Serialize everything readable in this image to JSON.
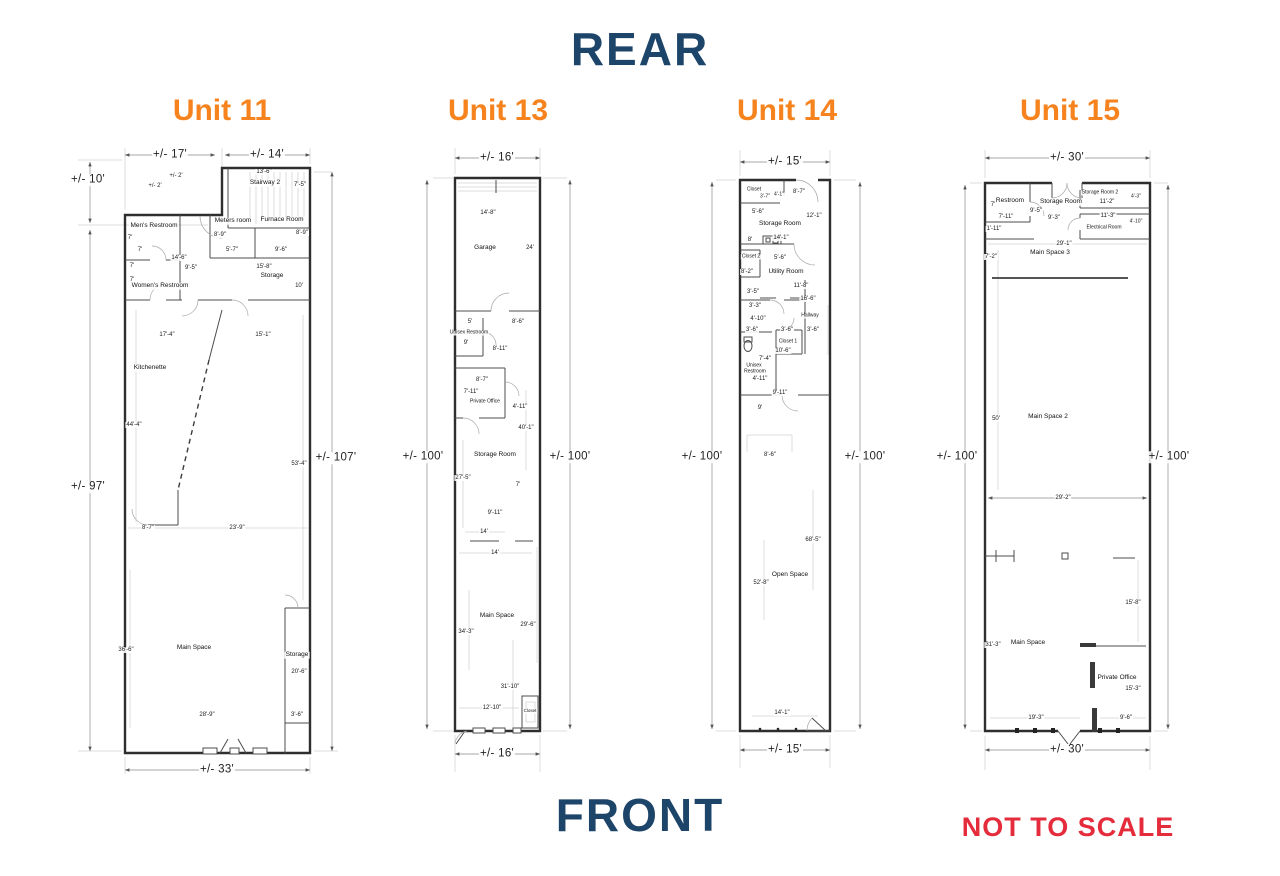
{
  "page": {
    "rear_label": "REAR",
    "front_label": "FRONT",
    "not_to_scale": "NOT TO SCALE",
    "colors": {
      "heading_navy": "#1d4469",
      "unit_orange": "#f6831d",
      "warning_red": "#e52c3c",
      "wall": "#2e2e2e"
    }
  },
  "units": [
    {
      "title": "Unit 11",
      "labels": [
        {
          "t": "+/- 17'",
          "x": 100,
          "y": 15,
          "c": "big"
        },
        {
          "t": "+/- 14'",
          "x": 197,
          "y": 15,
          "c": "big"
        },
        {
          "t": "+/- 10'",
          "x": 18,
          "y": 40,
          "c": "big"
        },
        {
          "t": "+/- 97'",
          "x": 18,
          "y": 347,
          "c": "big"
        },
        {
          "t": "+/- 107'",
          "x": 266,
          "y": 318,
          "c": "big"
        },
        {
          "t": "+/- 33'",
          "x": 147,
          "y": 630,
          "c": "big"
        },
        {
          "t": "+/- 2'",
          "x": 106,
          "y": 36
        },
        {
          "t": "+/- 2'",
          "x": 85,
          "y": 46
        },
        {
          "t": "13'-6\"",
          "x": 194,
          "y": 32
        },
        {
          "t": "Stairway 2",
          "x": 195,
          "y": 43,
          "c": "room"
        },
        {
          "t": "7'-5\"",
          "x": 230,
          "y": 45
        },
        {
          "t": "Meters room",
          "x": 163,
          "y": 81,
          "c": "room"
        },
        {
          "t": "Furnace Room",
          "x": 212,
          "y": 80,
          "c": "room"
        },
        {
          "t": "8'-9\"",
          "x": 150,
          "y": 95
        },
        {
          "t": "8'-9\"",
          "x": 232,
          "y": 93
        },
        {
          "t": "5'-7\"",
          "x": 162,
          "y": 110
        },
        {
          "t": "9'-6\"",
          "x": 211,
          "y": 110
        },
        {
          "t": "15'-8\"",
          "x": 194,
          "y": 127
        },
        {
          "t": "Storage",
          "x": 202,
          "y": 136,
          "c": "room"
        },
        {
          "t": "10'",
          "x": 229,
          "y": 146
        },
        {
          "t": "Men's Restroom",
          "x": 84,
          "y": 86,
          "c": "room"
        },
        {
          "t": "7'",
          "x": 60,
          "y": 98
        },
        {
          "t": "7'",
          "x": 70,
          "y": 110
        },
        {
          "t": "14'-6\"",
          "x": 109,
          "y": 118
        },
        {
          "t": "7'",
          "x": 62,
          "y": 126
        },
        {
          "t": "9'-5\"",
          "x": 121,
          "y": 128
        },
        {
          "t": "7'",
          "x": 62,
          "y": 140
        },
        {
          "t": "Women's Restroom",
          "x": 90,
          "y": 146,
          "c": "room"
        },
        {
          "t": "17'-4\"",
          "x": 97,
          "y": 195
        },
        {
          "t": "15'-1\"",
          "x": 193,
          "y": 195
        },
        {
          "t": "Kitchenette",
          "x": 80,
          "y": 228,
          "c": "room"
        },
        {
          "t": "44'-4\"",
          "x": 64,
          "y": 285
        },
        {
          "t": "53'-4\"",
          "x": 229,
          "y": 324
        },
        {
          "t": "8'-7\"",
          "x": 78,
          "y": 388
        },
        {
          "t": "23'-9\"",
          "x": 167,
          "y": 388
        },
        {
          "t": "36'-6\"",
          "x": 56,
          "y": 510
        },
        {
          "t": "Main Space",
          "x": 124,
          "y": 508,
          "c": "room"
        },
        {
          "t": "Storage",
          "x": 227,
          "y": 515,
          "c": "room"
        },
        {
          "t": "20'-6\"",
          "x": 229,
          "y": 532
        },
        {
          "t": "28'-9\"",
          "x": 137,
          "y": 575
        },
        {
          "t": "3'-6\"",
          "x": 227,
          "y": 575
        }
      ]
    },
    {
      "title": "Unit 13",
      "labels": [
        {
          "t": "+/- 16'",
          "x": 102,
          "y": 18,
          "c": "big"
        },
        {
          "t": "+/- 100'",
          "x": 28,
          "y": 317,
          "c": "big"
        },
        {
          "t": "+/- 100'",
          "x": 175,
          "y": 317,
          "c": "big"
        },
        {
          "t": "+/- 16'",
          "x": 102,
          "y": 614,
          "c": "big"
        },
        {
          "t": "14'-8\"",
          "x": 93,
          "y": 73
        },
        {
          "t": "Garage",
          "x": 90,
          "y": 108,
          "c": "room"
        },
        {
          "t": "24'",
          "x": 135,
          "y": 108
        },
        {
          "t": "5'",
          "x": 75,
          "y": 182
        },
        {
          "t": "8'-6\"",
          "x": 123,
          "y": 182
        },
        {
          "t": "Unisex Restroom",
          "x": 74,
          "y": 193,
          "c": "room",
          "s": 5
        },
        {
          "t": "9'",
          "x": 71,
          "y": 203
        },
        {
          "t": "8'-11\"",
          "x": 105,
          "y": 209
        },
        {
          "t": "8'-7\"",
          "x": 87,
          "y": 240
        },
        {
          "t": "7'-11\"",
          "x": 76,
          "y": 252
        },
        {
          "t": "Private Office",
          "x": 90,
          "y": 262,
          "c": "room",
          "s": 5
        },
        {
          "t": "4'-11\"",
          "x": 125,
          "y": 267
        },
        {
          "t": "40'-1\"",
          "x": 131,
          "y": 288
        },
        {
          "t": "Storage Room",
          "x": 100,
          "y": 315,
          "c": "room"
        },
        {
          "t": "27'-5\"",
          "x": 68,
          "y": 338
        },
        {
          "t": "7'",
          "x": 123,
          "y": 345
        },
        {
          "t": "9'-11\"",
          "x": 100,
          "y": 373
        },
        {
          "t": "14'",
          "x": 89,
          "y": 392
        },
        {
          "t": "14'",
          "x": 100,
          "y": 413
        },
        {
          "t": "Main Space",
          "x": 102,
          "y": 476,
          "c": "room"
        },
        {
          "t": "29'-6\"",
          "x": 133,
          "y": 485
        },
        {
          "t": "34'-3\"",
          "x": 71,
          "y": 492
        },
        {
          "t": "31'-10\"",
          "x": 115,
          "y": 547
        },
        {
          "t": "12'-10\"",
          "x": 97,
          "y": 568
        },
        {
          "t": "Closet",
          "x": 135,
          "y": 571,
          "c": "room",
          "s": 4.5
        }
      ]
    },
    {
      "title": "Unit 14",
      "labels": [
        {
          "t": "+/- 15'",
          "x": 125,
          "y": 22,
          "c": "big"
        },
        {
          "t": "+/- 100'",
          "x": 42,
          "y": 317,
          "c": "big"
        },
        {
          "t": "+/- 100'",
          "x": 205,
          "y": 317,
          "c": "big"
        },
        {
          "t": "+/- 15'",
          "x": 125,
          "y": 610,
          "c": "big"
        },
        {
          "t": "Closet",
          "x": 94,
          "y": 50,
          "c": "room",
          "s": 5
        },
        {
          "t": "3'-7\"",
          "x": 105,
          "y": 57,
          "s": 5
        },
        {
          "t": "4'-1\"",
          "x": 119,
          "y": 55,
          "s": 5
        },
        {
          "t": "8'-7\"",
          "x": 139,
          "y": 52
        },
        {
          "t": "5'-6\"",
          "x": 98,
          "y": 72
        },
        {
          "t": "Storage Room",
          "x": 120,
          "y": 84,
          "c": "room"
        },
        {
          "t": "12'-1\"",
          "x": 154,
          "y": 76
        },
        {
          "t": "8'",
          "x": 90,
          "y": 100
        },
        {
          "t": "14'-1\"",
          "x": 121,
          "y": 98
        },
        {
          "t": "Closet 2",
          "x": 91,
          "y": 117,
          "c": "room",
          "s": 5
        },
        {
          "t": "5'-6\"",
          "x": 120,
          "y": 118
        },
        {
          "t": "8'-2\"",
          "x": 87,
          "y": 132
        },
        {
          "t": "Utility Room",
          "x": 126,
          "y": 132,
          "c": "room"
        },
        {
          "t": "11'-8\"",
          "x": 141,
          "y": 146
        },
        {
          "t": "3'-5\"",
          "x": 93,
          "y": 152
        },
        {
          "t": "16'-6\"",
          "x": 148,
          "y": 159
        },
        {
          "t": "3'-3\"",
          "x": 95,
          "y": 166
        },
        {
          "t": "Hallway",
          "x": 150,
          "y": 176,
          "c": "room",
          "s": 5
        },
        {
          "t": "4'-10\"",
          "x": 98,
          "y": 179
        },
        {
          "t": "3'-6\"",
          "x": 92,
          "y": 190
        },
        {
          "t": "3'-6\"",
          "x": 127,
          "y": 190
        },
        {
          "t": "3'-6\"",
          "x": 153,
          "y": 190
        },
        {
          "t": "Closet 1",
          "x": 128,
          "y": 202,
          "c": "room",
          "s": 5
        },
        {
          "t": "10'-6\"",
          "x": 123,
          "y": 211
        },
        {
          "t": "7'-4\"",
          "x": 105,
          "y": 219
        },
        {
          "t": "Unisex",
          "x": 94,
          "y": 226,
          "c": "room",
          "s": 5
        },
        {
          "t": "Restroom",
          "x": 95,
          "y": 232,
          "c": "room",
          "s": 5
        },
        {
          "t": "4'-11\"",
          "x": 100,
          "y": 239
        },
        {
          "t": "9'-11\"",
          "x": 120,
          "y": 253
        },
        {
          "t": "9'",
          "x": 100,
          "y": 268
        },
        {
          "t": "8'-6\"",
          "x": 110,
          "y": 315
        },
        {
          "t": "68'-5\"",
          "x": 153,
          "y": 400
        },
        {
          "t": "Open Space",
          "x": 130,
          "y": 435,
          "c": "room"
        },
        {
          "t": "52'-8\"",
          "x": 101,
          "y": 443
        },
        {
          "t": "14'-1\"",
          "x": 122,
          "y": 573
        }
      ]
    },
    {
      "title": "Unit 15",
      "labels": [
        {
          "t": "+/- 30'",
          "x": 137,
          "y": 18,
          "c": "big"
        },
        {
          "t": "+/- 100'",
          "x": 27,
          "y": 317,
          "c": "big"
        },
        {
          "t": "+/- 100'",
          "x": 239,
          "y": 317,
          "c": "big"
        },
        {
          "t": "+/- 30'",
          "x": 137,
          "y": 610,
          "c": "big"
        },
        {
          "t": "Restroom",
          "x": 80,
          "y": 61,
          "c": "room"
        },
        {
          "t": "7'",
          "x": 63,
          "y": 65
        },
        {
          "t": "7'-11\"",
          "x": 76,
          "y": 77
        },
        {
          "t": "Storage Room",
          "x": 131,
          "y": 62,
          "c": "room"
        },
        {
          "t": "9'-5\"",
          "x": 106,
          "y": 71
        },
        {
          "t": "9'-3\"",
          "x": 124,
          "y": 78
        },
        {
          "t": "Storage Room 2",
          "x": 170,
          "y": 53,
          "c": "room",
          "s": 5
        },
        {
          "t": "4'-3\"",
          "x": 206,
          "y": 57,
          "s": 5
        },
        {
          "t": "11'-2\"",
          "x": 177,
          "y": 62
        },
        {
          "t": "11'-3\"",
          "x": 178,
          "y": 76
        },
        {
          "t": "Electrical Room",
          "x": 174,
          "y": 88,
          "c": "room",
          "s": 5
        },
        {
          "t": "4'-10\"",
          "x": 206,
          "y": 82,
          "s": 5
        },
        {
          "t": "1'-11\"",
          "x": 64,
          "y": 89
        },
        {
          "t": "29'-1\"",
          "x": 134,
          "y": 104
        },
        {
          "t": "Main Space 3",
          "x": 120,
          "y": 113,
          "c": "room"
        },
        {
          "t": "7'-2\"",
          "x": 61,
          "y": 117
        },
        {
          "t": "50'",
          "x": 66,
          "y": 279
        },
        {
          "t": "Main Space 2",
          "x": 118,
          "y": 277,
          "c": "room"
        },
        {
          "t": "29'-2\"",
          "x": 133,
          "y": 358
        },
        {
          "t": "15'-8\"",
          "x": 203,
          "y": 463
        },
        {
          "t": "31'-3\"",
          "x": 63,
          "y": 505
        },
        {
          "t": "Main Space",
          "x": 98,
          "y": 503,
          "c": "room"
        },
        {
          "t": "Private Office",
          "x": 187,
          "y": 538,
          "c": "room"
        },
        {
          "t": "15'-3\"",
          "x": 203,
          "y": 549
        },
        {
          "t": "19'-3\"",
          "x": 106,
          "y": 578
        },
        {
          "t": "9'-6\"",
          "x": 196,
          "y": 578
        }
      ]
    }
  ]
}
